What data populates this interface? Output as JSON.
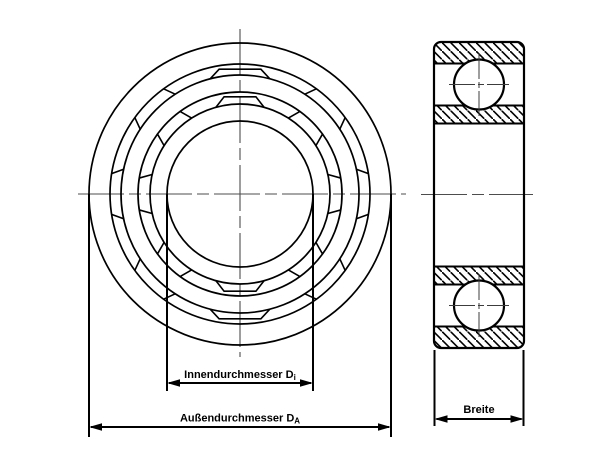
{
  "diagram": {
    "type": "technical-drawing",
    "subject": "ball bearing dimension drawing",
    "views": [
      "front-view",
      "cross-section-view"
    ]
  },
  "labels": {
    "inner_diameter": {
      "text": "Innendurchmesser D",
      "sub": "i"
    },
    "outer_diameter": {
      "text": "Außendurchmesser D",
      "sub": "A"
    },
    "width": {
      "text": "Breite"
    }
  },
  "colors": {
    "line": "#000000",
    "centerline": "#4d4d4d",
    "crosshair": "#3c3c3c",
    "background": "#ffffff"
  },
  "front_view": {
    "center": {
      "x": 240,
      "y": 194
    },
    "circle_radii": [
      151,
      130,
      119,
      102,
      90,
      73
    ],
    "bands": [
      {
        "r_outer": 130,
        "r_inner": 119,
        "chord_r": 126.5,
        "trap_half_outer": 9.5,
        "trap_half_inner": 14.5,
        "line_half_outer": 9,
        "line_half_inner": 12
      },
      {
        "r_outer": 102,
        "r_inner": 90,
        "chord_r": 98.5,
        "trap_half_outer": 9.3,
        "trap_half_inner": 15.5,
        "line_half_outer": 9,
        "line_half_inner": 12.5
      }
    ],
    "trapezoid_angles": [
      0,
      180
    ],
    "pocket_angles": [
      45,
      90,
      135,
      225,
      270,
      315
    ],
    "v_centerline": {
      "x": 240,
      "y1": 29,
      "y2": 357
    },
    "h_centerline": {
      "y": 194,
      "x1": 78,
      "x2": 406
    }
  },
  "side_view": {
    "block": {
      "x1": 434,
      "x2": 524,
      "y1": 42,
      "y2": 348,
      "corner": 7
    },
    "hatch_bands": [
      [
        42,
        63.5
      ],
      [
        105.5,
        123.5
      ],
      [
        266.5,
        284.5
      ],
      [
        326.5,
        348
      ]
    ],
    "boundary_lines_y": [
      63.5,
      105.5,
      123.5,
      266.5,
      284.5,
      326.5
    ],
    "balls": [
      {
        "cx": 479,
        "cy": 84.5,
        "r": 25
      },
      {
        "cx": 479,
        "cy": 305.5,
        "r": 25
      }
    ],
    "crosshair_h_ext": 30,
    "crosshair_v_ext": 31.5,
    "h_centerline": {
      "y": 194.5,
      "x1": 421,
      "x2": 533
    },
    "hatch": {
      "spacing": 8.5,
      "stroke": 1.6
    }
  },
  "dimensions": {
    "outer": {
      "ext_x": [
        89,
        391
      ],
      "ext_y1": 194,
      "ext_y2": 437,
      "line_y": 427,
      "label_x": 240,
      "label_y": 421.5
    },
    "inner": {
      "ext_x": [
        167,
        313
      ],
      "ext_y1": 194,
      "ext_y2": 391,
      "line_y": 383,
      "label_x": 240,
      "label_y": 378
    },
    "width": {
      "ext_x": [
        434.5,
        523.5
      ],
      "ext_y1": 350,
      "ext_y2": 426,
      "line_y": 419,
      "label_x": 479,
      "label_y": 413
    },
    "arrow": {
      "len": 13,
      "half_w": 3.8
    }
  }
}
